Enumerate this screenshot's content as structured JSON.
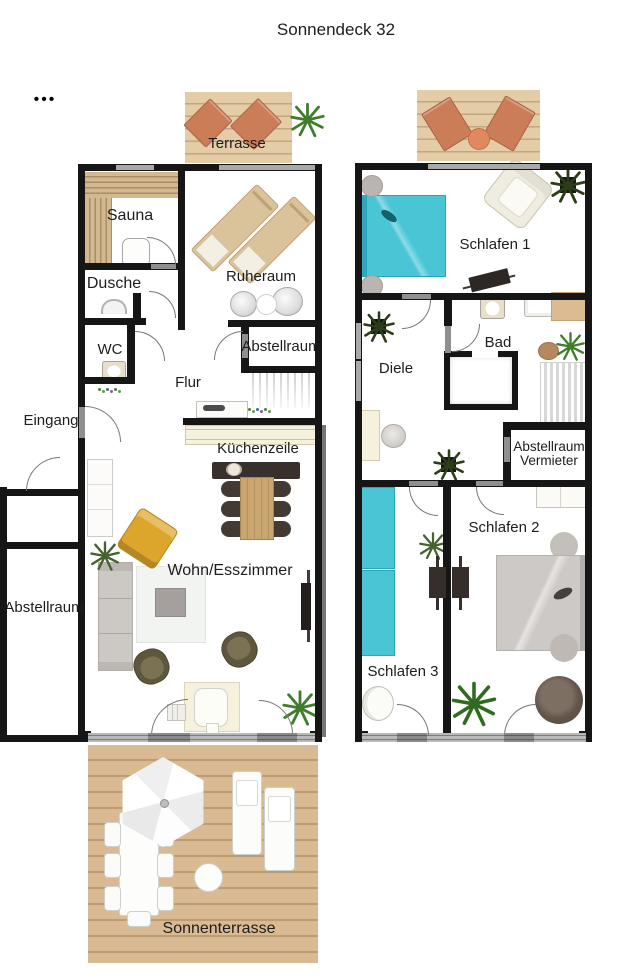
{
  "title": "Sonnendeck 32",
  "menu_dots": "•••",
  "floors": {
    "ground": {
      "rooms": {
        "terrasse": "Terrasse",
        "sauna": "Sauna",
        "dusche": "Dusche",
        "wc": "WC",
        "flur": "Flur",
        "eingang": "Eingang",
        "abstellraum_flur": "Abstellraum",
        "ruheraum": "Ruheraum",
        "kuechenzeile": "Küchenzeile",
        "wohn_esszimmer": "Wohn/Esszimmer",
        "abstellraum_links": "Abstellraum",
        "sonnenterrasse": "Sonnenterrasse"
      }
    },
    "upper": {
      "rooms": {
        "schlafen1": "Schlafen 1",
        "bad": "Bad",
        "diele": "Diele",
        "abstellraum_vermieter_1": "Abstellraum",
        "abstellraum_vermieter_2": "Vermieter",
        "schlafen2": "Schlafen 2",
        "schlafen3": "Schlafen 3"
      }
    }
  },
  "colors": {
    "wall": "#161616",
    "window-gray": "#a9a9a9",
    "door-gray": "#8f8f8f",
    "deck-wood": "#e4cca6",
    "deck-wood-dark": "#d9ba92",
    "terracotta": "#cb7d58",
    "bed-teal": "#49c5d6",
    "bed-teal-light": "#8fe0ea",
    "bed-gray": "#cdc9c6",
    "sofa-gray": "#ccc8c3",
    "accent-yellow": "#dca52c",
    "olive": "#5f573d",
    "cream": "#f6f1dd",
    "wood-table": "#c9a670",
    "dark-furniture": "#38302c",
    "plant-green": "#3f7d2c",
    "plant-dark": "#2c3d18",
    "label": "#1d1d1d"
  }
}
